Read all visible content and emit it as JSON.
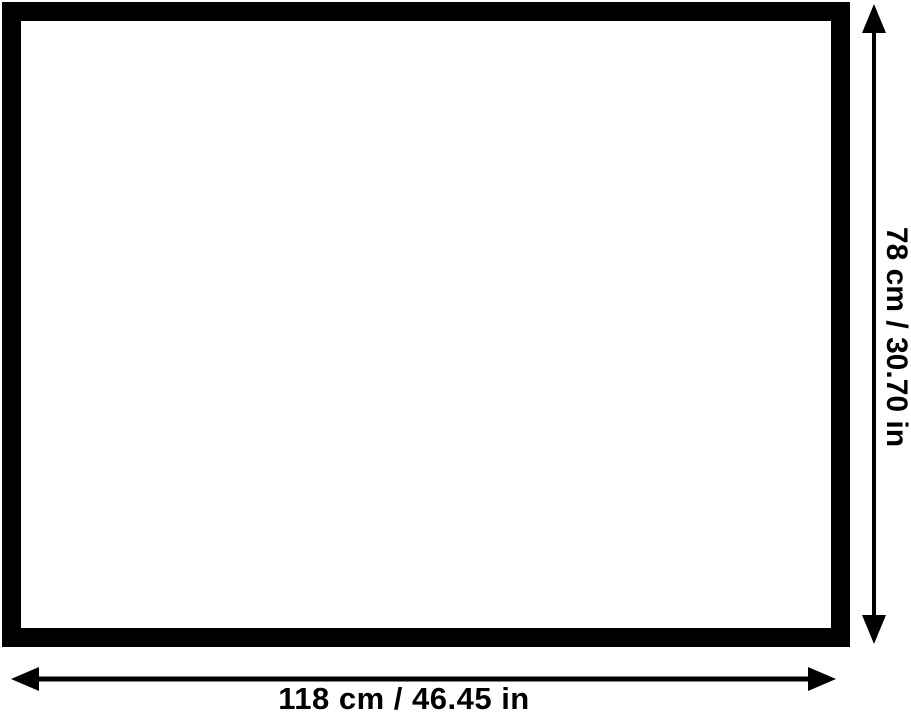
{
  "diagram": {
    "kind": "product-dimension-diagram",
    "board": {
      "description": "blank board with thick black frame",
      "frame_color": "#000000",
      "surface_color": "#ffffff"
    },
    "dimensions": {
      "width_label": "118 cm / 46.45 in",
      "height_label": "78 cm / 30.70 in"
    },
    "colors": {
      "ink": "#000000",
      "background": "#ffffff"
    }
  }
}
